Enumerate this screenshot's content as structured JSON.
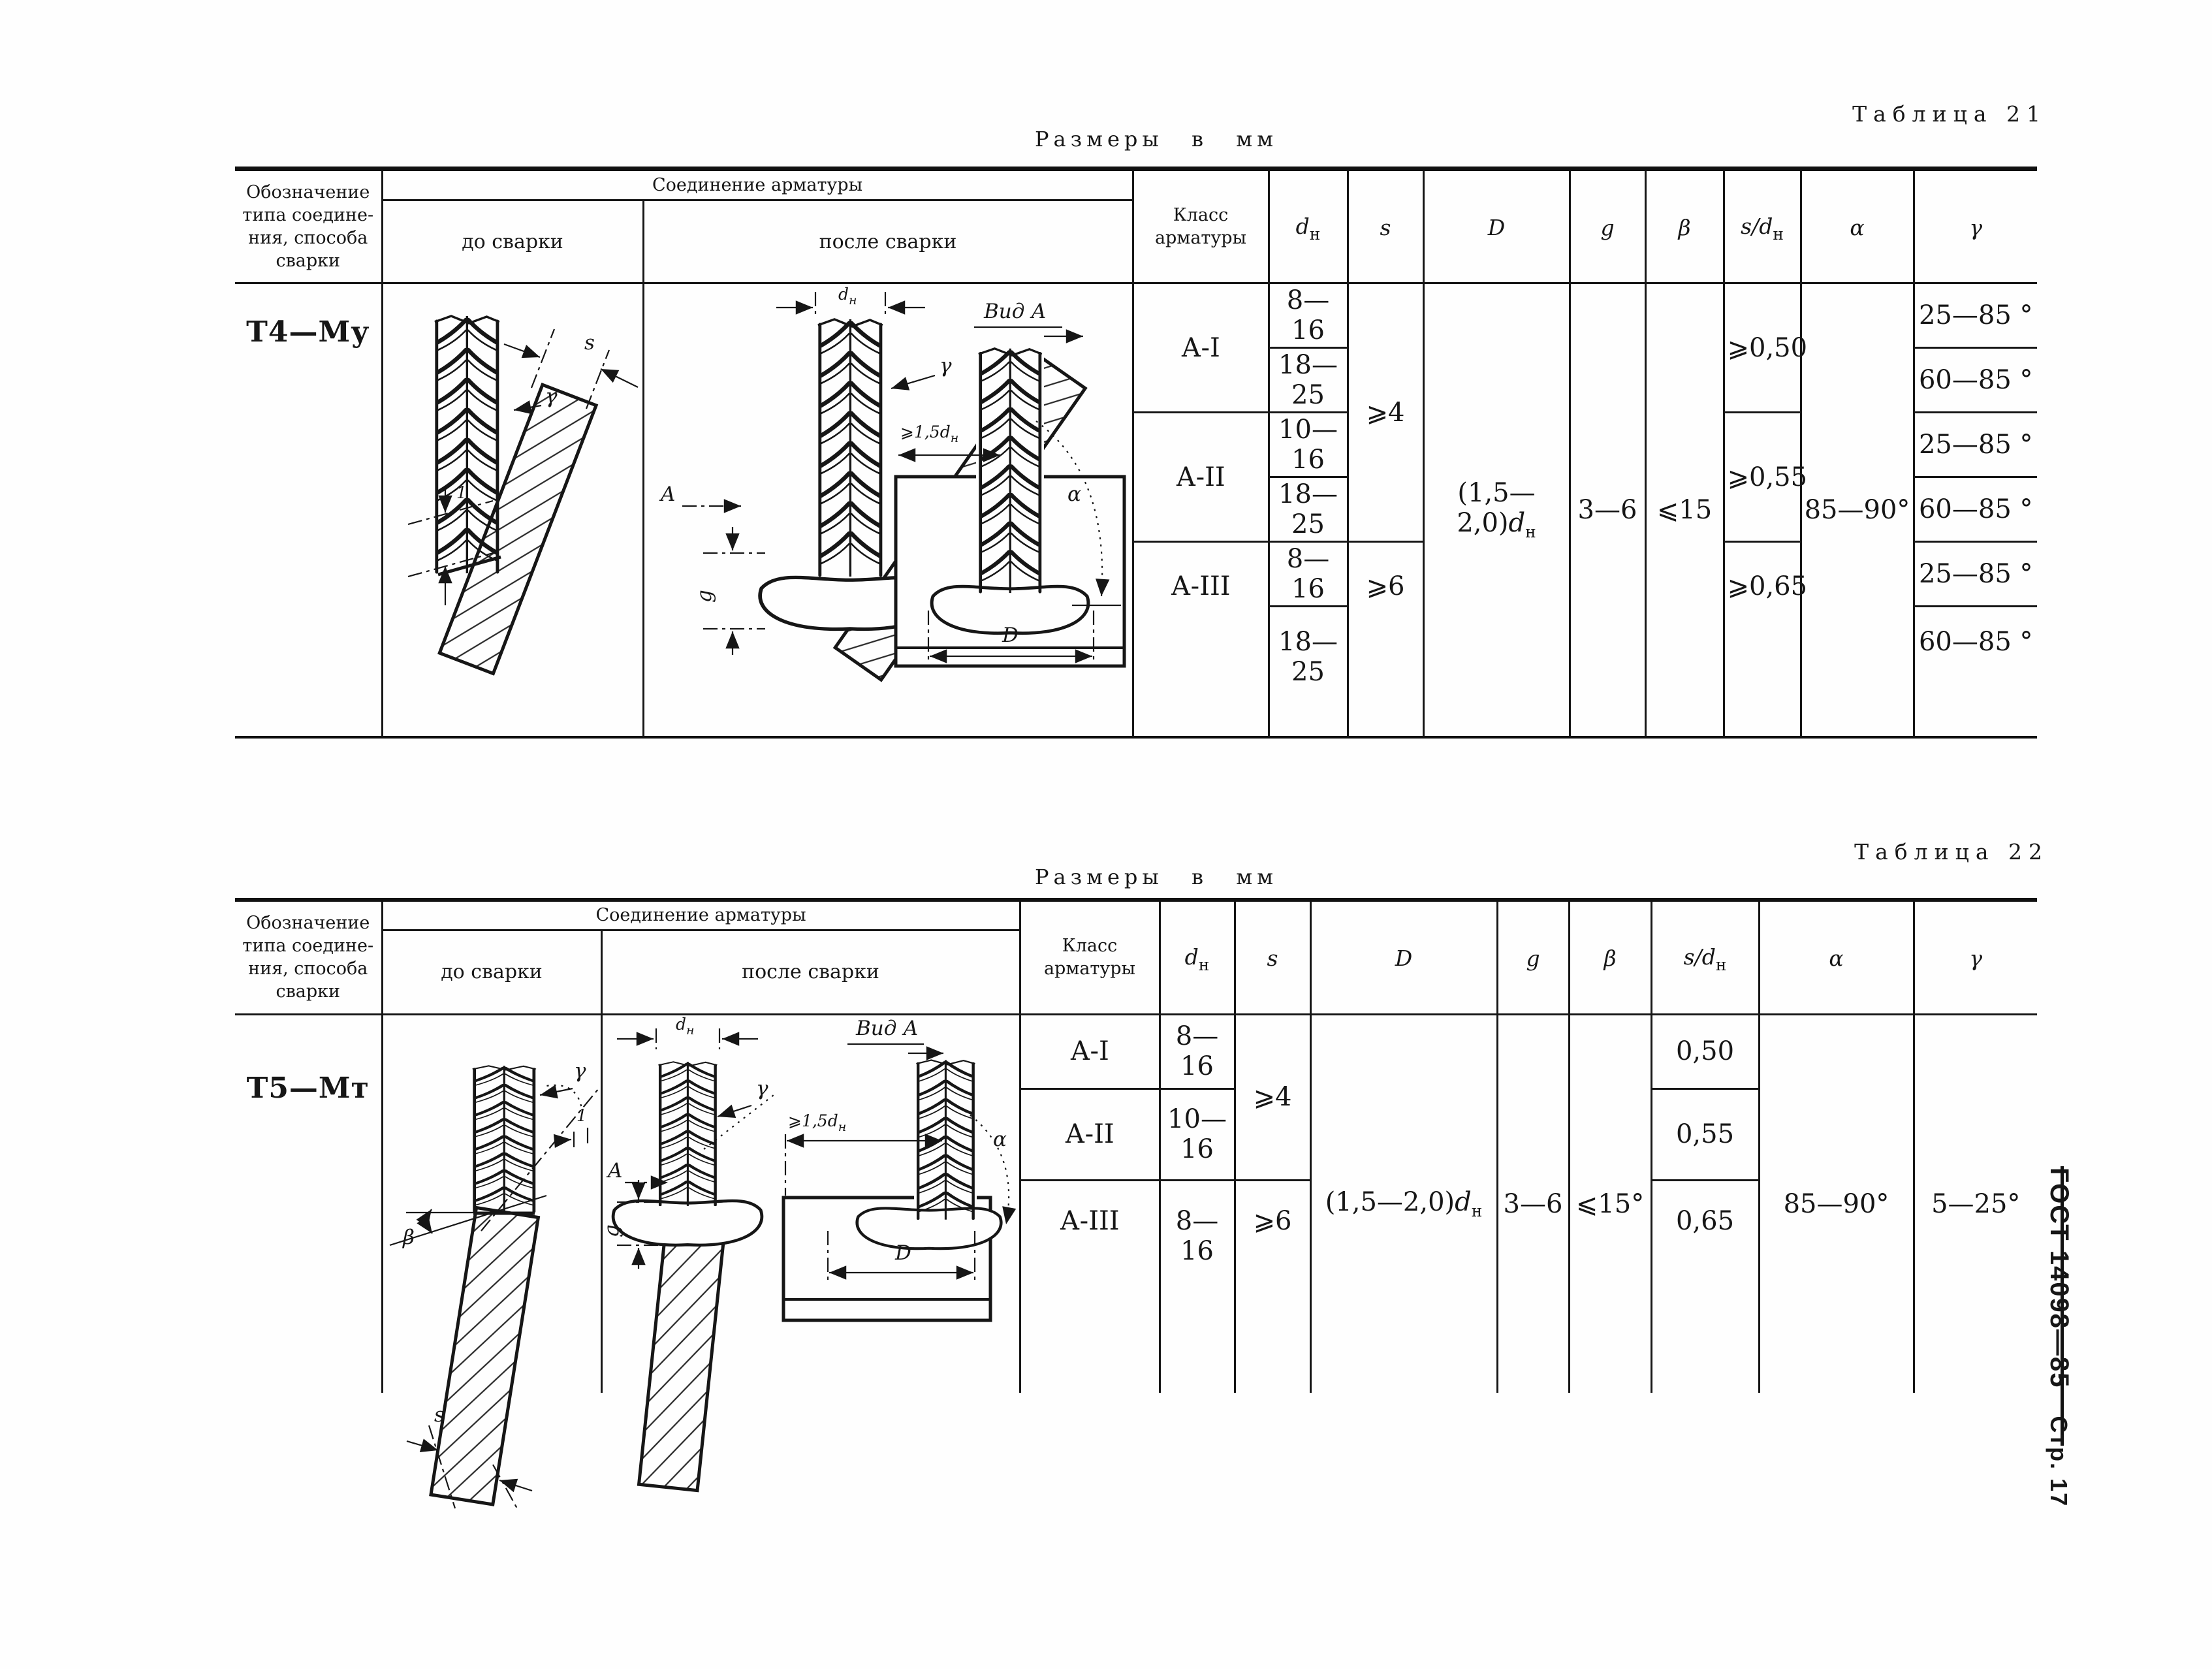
{
  "page": {
    "table21_caption": "Таблица 21",
    "table22_caption": "Таблица 22",
    "units_label": "Размеры в мм",
    "gost_label": "ГОСТ 14098—85",
    "page_label": "Стр. 17"
  },
  "columns": {
    "designation": "Обозначение\nтипа соедине-\nния, способа\nсварки",
    "joint": "Соединение арматуры",
    "before": "до сварки",
    "after": "после сварки",
    "klass": "Класс\nарматуры",
    "dn": {
      "sym": "d",
      "sub": "н"
    },
    "s": "s",
    "D": "D",
    "g": "g",
    "beta": "β",
    "sdn": {
      "sym": "s/d",
      "sub": "н"
    },
    "alpha": "α",
    "gamma": "γ"
  },
  "table21": {
    "designation": "Т4—Му",
    "classes": [
      "А-I",
      "А-II",
      "А-III"
    ],
    "dn": [
      "8—16",
      "18—25",
      "10—16",
      "18—25",
      "8—16",
      "18—25"
    ],
    "s": [
      "⩾4",
      "⩾6"
    ],
    "D": {
      "pre": "(1,5—2,0)",
      "sym": "d",
      "sub": "н"
    },
    "g": "3—6",
    "beta": "⩽15",
    "sdn": [
      "⩾0,50",
      "⩾0,55",
      "⩾0,65"
    ],
    "alpha": "85—90°",
    "gamma": [
      "25—85 °",
      "60—85 °",
      "25—85 °",
      "60—85 °",
      "25—85 °",
      "60—85 °"
    ]
  },
  "table22": {
    "designation": "Т5—Мт",
    "classes": [
      "А-I",
      "А-II",
      "А-III"
    ],
    "dn": [
      "8—16",
      "10—16",
      "8—16"
    ],
    "s": [
      "⩾4",
      "⩾6"
    ],
    "D": {
      "pre": "(1,5—2,0)",
      "sym": "d",
      "sub": "н"
    },
    "g": "3—6",
    "beta": "⩽15°",
    "sdn": [
      "0,50",
      "0,55",
      "0,65"
    ],
    "alpha": "85—90°",
    "gamma": "5—25°"
  },
  "drawings": {
    "vid_a": "Вид А",
    "dn": {
      "sym": "d",
      "sub": "н"
    },
    "min15dn": {
      "pre": "⩾1,5",
      "sym": "d",
      "sub": "н"
    },
    "gamma": "γ",
    "s": "s",
    "g": "g",
    "alpha": "α",
    "beta": "β",
    "one": "1",
    "a_view": "A",
    "D": "D"
  }
}
